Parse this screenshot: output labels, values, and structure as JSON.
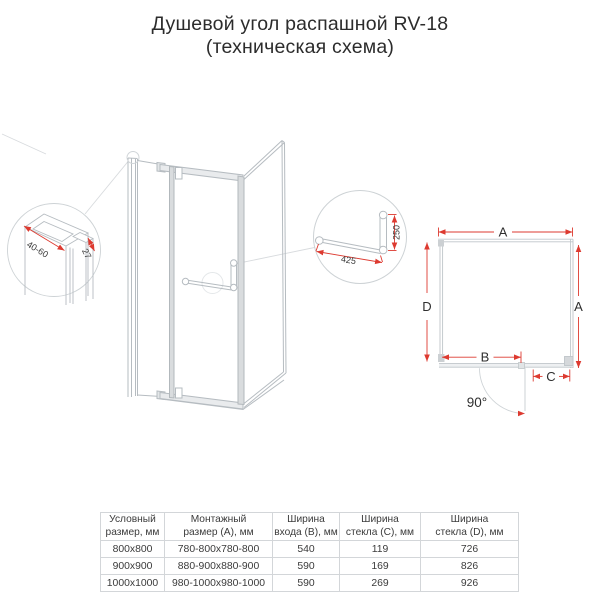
{
  "title": {
    "line1": "Душевой угол распашной RV-18",
    "line2": "(техническая схема)"
  },
  "diagram": {
    "left_detail": {
      "width_label": "40-60",
      "depth_label": "27"
    },
    "handle_detail": {
      "length_label": "425",
      "height_label": "250"
    },
    "plan": {
      "top_label": "A",
      "left_label": "D",
      "right_label": "A",
      "entry_label": "B",
      "fixed_label": "C",
      "angle_label": "90°"
    }
  },
  "table": {
    "headers": [
      "Условный\nразмер, мм",
      "Монтажный\nразмер (A), мм",
      "Ширина\nвхода (B), мм",
      "Ширина\nстекла (C), мм",
      "Ширина\nстекла (D), мм"
    ],
    "rows": [
      [
        "800x800",
        "780-800x780-800",
        "540",
        "119",
        "726"
      ],
      [
        "900x900",
        "880-900x880-900",
        "590",
        "169",
        "826"
      ],
      [
        "1000x1000",
        "980-1000x980-1000",
        "590",
        "269",
        "926"
      ]
    ]
  },
  "colors": {
    "dimension_red": "#dd3a30",
    "line_gray": "#b9bfc4"
  }
}
